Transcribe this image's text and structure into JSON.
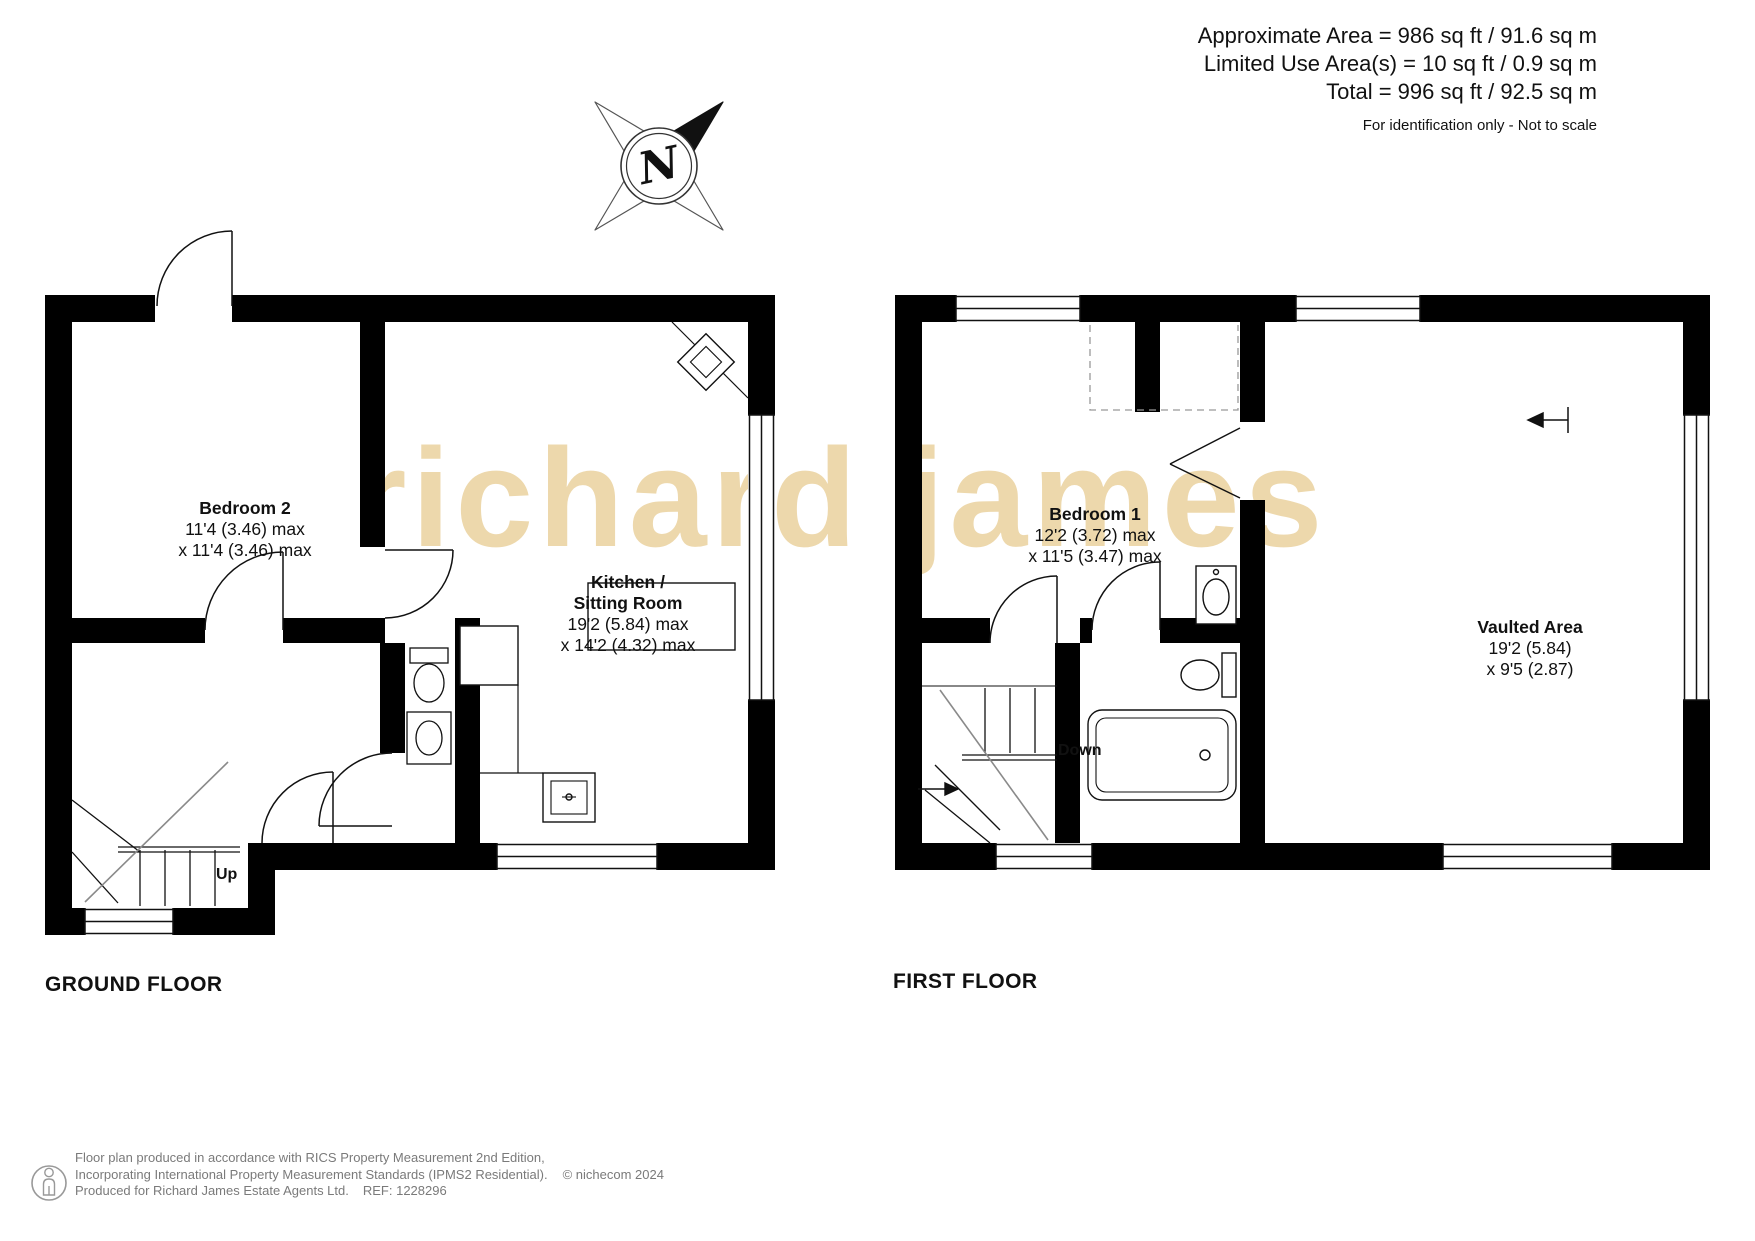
{
  "header": {
    "line1": "Approximate Area = 986 sq ft / 91.6 sq m",
    "line2": "Limited Use Area(s) = 10 sq ft / 0.9 sq m",
    "line3": "Total = 996 sq ft / 92.5 sq m",
    "disclaimer": "For identification only - Not to scale"
  },
  "compass": {
    "label": "N"
  },
  "watermark_text": "richard james",
  "ground_floor": {
    "title": "GROUND FLOOR",
    "stairs_label": "Up",
    "bedroom2": {
      "name": "Bedroom 2",
      "dim1": "11'4 (3.46) max",
      "dim2": "x 11'4 (3.46) max"
    },
    "kitchen": {
      "name1": "Kitchen /",
      "name2": "Sitting Room",
      "dim1": "19'2 (5.84) max",
      "dim2": "x 14'2 (4.32) max"
    }
  },
  "first_floor": {
    "title": "FIRST FLOOR",
    "stairs_label": "Down",
    "bedroom1": {
      "name": "Bedroom 1",
      "dim1": "12'2 (3.72) max",
      "dim2": "x 11'5 (3.47) max"
    },
    "vaulted": {
      "name": "Vaulted Area",
      "dim1": "19'2 (5.84)",
      "dim2": "x 9'5 (2.87)"
    }
  },
  "footer": {
    "line1": "Floor plan produced in accordance with RICS Property Measurement 2nd Edition,",
    "line2": "Incorporating International Property Measurement Standards (IPMS2 Residential).",
    "copyright": "© nichecom 2024",
    "line3": "Produced for Richard James Estate Agents Ltd.",
    "ref": "REF: 1228296"
  },
  "colors": {
    "wall": "#000000",
    "line": "#111111",
    "stair_rail": "#8a8a8a",
    "watermark": "#edd8ac",
    "footer_text": "#7a7a7a"
  }
}
